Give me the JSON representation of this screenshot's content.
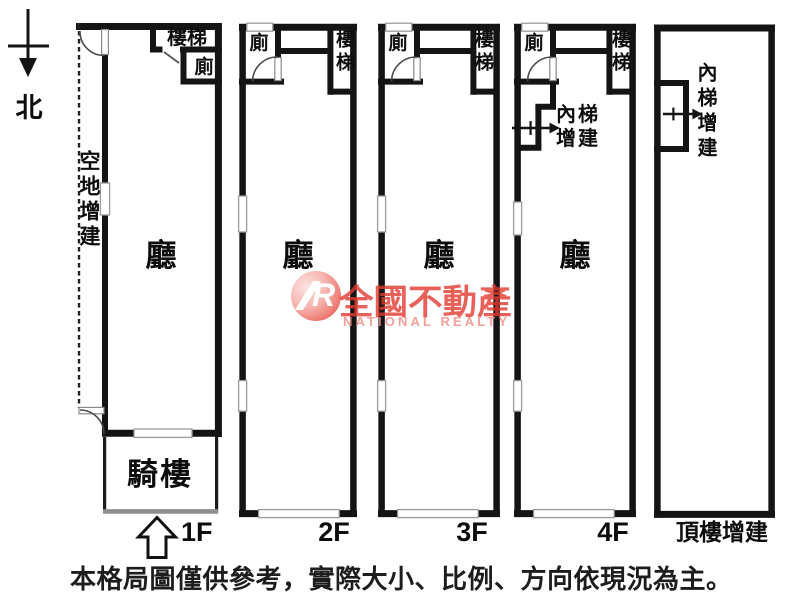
{
  "compass": {
    "north_label": "北"
  },
  "plans": {
    "f1": {
      "side_yard": "空地增建",
      "stairs": "樓梯",
      "toilet": "廁",
      "hall": "廳",
      "arcade": "騎樓",
      "floor_label": "1F"
    },
    "f2": {
      "toilet": "廁",
      "stairs": "樓梯",
      "hall": "廳",
      "floor_label": "2F"
    },
    "f3": {
      "toilet": "廁",
      "stairs": "樓梯",
      "hall": "廳",
      "floor_label": "3F"
    },
    "f4": {
      "toilet": "廁",
      "stairs": "樓梯",
      "inner_stair_line1": "內梯",
      "inner_stair_line2": "增建",
      "hall": "廳",
      "floor_label": "4F"
    },
    "roof": {
      "inner_stair": "內梯增建",
      "floor_label": "頂樓增建"
    }
  },
  "watermark": {
    "logo_letter": "R",
    "brand": "全國不動產",
    "subtitle": "NATIONAL REALTY",
    "brand_color": "#e23a30",
    "subtitle_color": "#f0908a"
  },
  "footer": {
    "disclaimer": "本格局圖僅供參考，實際大小、比例、方向依現況為主。"
  }
}
